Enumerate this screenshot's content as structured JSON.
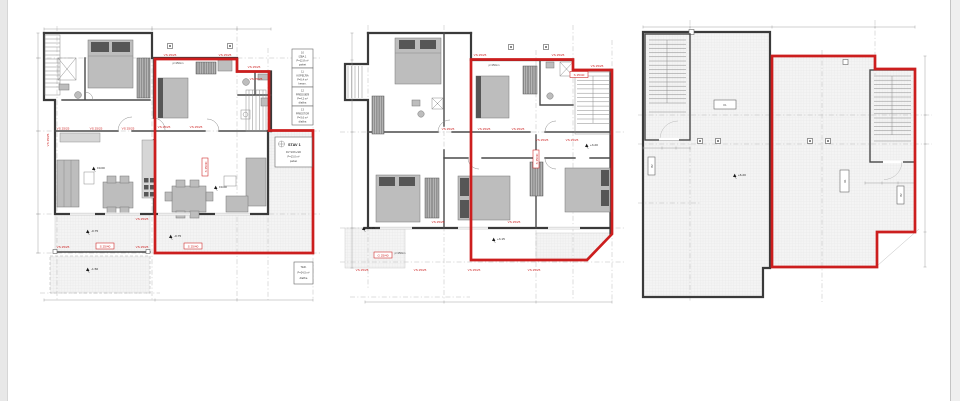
{
  "image": {
    "kind": "architectural floor plans, three storeys side by side",
    "highlight_color": "#cc1e1e"
  },
  "labels": {
    "vs": "VS 25/25",
    "beam": "S 25/40",
    "beam_g": "G 25/40",
    "k1": "K1",
    "b2": "B2",
    "sill": "p=150cm"
  },
  "elevations": {
    "zero": "±0.00",
    "ground_terrace": "-0.75",
    "ground_garden": "-1.50",
    "floor_main": "+3.20",
    "floor_terrace": "+3.15",
    "roof": "+6.20"
  },
  "schedule": {
    "boxes": [
      {
        "lines": [
          "10",
          "IZBA 1",
          "P=12,8 m²",
          "parket"
        ]
      },
      {
        "lines": [
          "11",
          "KÚPEĽŇA",
          "P=5,4 m²",
          "keram."
        ]
      },
      {
        "lines": [
          "12",
          "PREDSIEŇ",
          "P=4,2 m²",
          "dlažba"
        ]
      },
      {
        "lines": [
          "13",
          "PRIESTOR",
          "P=3,6 m²",
          "dlažba"
        ]
      }
    ],
    "stav_box": {
      "title": "STAV 1",
      "lines": [
        "DV SOK+SD",
        "P=13,0 m²",
        "parket"
      ]
    },
    "terrace_box": {
      "lines": [
        "TER.",
        "P=24,5 m²",
        "dlažba"
      ]
    }
  }
}
